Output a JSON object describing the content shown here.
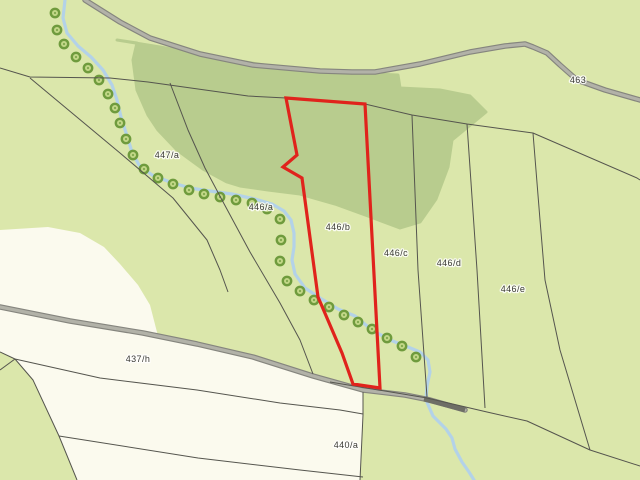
{
  "map": {
    "width": 640,
    "height": 480,
    "colors": {
      "field_green": "#dbe7ab",
      "forest_green": "#b8cc8e",
      "white_parcel": "#fbfaee",
      "stream_blue": "#b3d2e8",
      "tree_ring": "#6f9b3d",
      "tree_fill": "#c2d787",
      "road_casing": "#85857e",
      "road_fill": "#b2b2a8",
      "road_dark_segment": "#6e6e66",
      "boundary_line": "#55554e",
      "selected_parcel_red": "#e0231c",
      "label_text": "#3b3b35"
    },
    "selected_parcel": {
      "label": "446/b",
      "points": [
        [
          286,
          98
        ],
        [
          365,
          104
        ],
        [
          380,
          388
        ],
        [
          353,
          384
        ],
        [
          342,
          353
        ],
        [
          318,
          297
        ],
        [
          302,
          178
        ],
        [
          283,
          167
        ],
        [
          297,
          155
        ]
      ]
    },
    "labels": [
      {
        "id": "road-463",
        "text": "463",
        "x": 578,
        "y": 83
      },
      {
        "id": "parcel-447a",
        "text": "447/a",
        "x": 167,
        "y": 158
      },
      {
        "id": "parcel-446a",
        "text": "446/a",
        "x": 261,
        "y": 210
      },
      {
        "id": "parcel-446b",
        "text": "446/b",
        "x": 338,
        "y": 230
      },
      {
        "id": "parcel-446c",
        "text": "446/c",
        "x": 396,
        "y": 256
      },
      {
        "id": "parcel-446d",
        "text": "446/d",
        "x": 449,
        "y": 266
      },
      {
        "id": "parcel-446e",
        "text": "446/e",
        "x": 513,
        "y": 292
      },
      {
        "id": "parcel-437h",
        "text": "437/h",
        "x": 138,
        "y": 362
      },
      {
        "id": "parcel-440a",
        "text": "440/a",
        "x": 346,
        "y": 448
      }
    ],
    "geometry": {
      "forest": [
        [
          117,
          40
        ],
        [
          160,
          47
        ],
        [
          215,
          57
        ],
        [
          270,
          66
        ],
        [
          330,
          72
        ],
        [
          398,
          75
        ],
        [
          400,
          88
        ],
        [
          440,
          90
        ],
        [
          470,
          96
        ],
        [
          486,
          112
        ],
        [
          452,
          140
        ],
        [
          448,
          167
        ],
        [
          436,
          199
        ],
        [
          420,
          222
        ],
        [
          400,
          228
        ],
        [
          368,
          216
        ],
        [
          335,
          204
        ],
        [
          300,
          194
        ],
        [
          268,
          190
        ],
        [
          240,
          186
        ],
        [
          227,
          182
        ],
        [
          203,
          169
        ],
        [
          177,
          150
        ],
        [
          158,
          130
        ],
        [
          148,
          115
        ],
        [
          137,
          90
        ],
        [
          133,
          60
        ],
        [
          137,
          43
        ]
      ],
      "white_blob_above_road": [
        [
          0,
          230
        ],
        [
          48,
          227
        ],
        [
          80,
          233
        ],
        [
          104,
          247
        ],
        [
          120,
          264
        ],
        [
          138,
          285
        ],
        [
          150,
          305
        ],
        [
          158,
          336
        ],
        [
          100,
          325
        ],
        [
          40,
          314
        ],
        [
          0,
          307
        ]
      ],
      "white_area_below_road": [
        [
          0,
          309
        ],
        [
          70,
          322
        ],
        [
          143,
          334
        ],
        [
          197,
          345
        ],
        [
          253,
          358
        ],
        [
          313,
          378
        ],
        [
          363,
          392
        ],
        [
          363,
          415
        ],
        [
          360,
          480
        ],
        [
          77,
          480
        ],
        [
          59,
          436
        ],
        [
          33,
          380
        ],
        [
          15,
          359
        ],
        [
          0,
          352
        ]
      ],
      "stream": [
        [
          65,
          0
        ],
        [
          63,
          18
        ],
        [
          67,
          33
        ],
        [
          78,
          46
        ],
        [
          91,
          57
        ],
        [
          103,
          70
        ],
        [
          112,
          85
        ],
        [
          117,
          100
        ],
        [
          121,
          117
        ],
        [
          127,
          136
        ],
        [
          132,
          152
        ],
        [
          139,
          165
        ],
        [
          152,
          175
        ],
        [
          170,
          182
        ],
        [
          190,
          188
        ],
        [
          210,
          191
        ],
        [
          232,
          194
        ],
        [
          255,
          199
        ],
        [
          272,
          204
        ],
        [
          284,
          211
        ],
        [
          291,
          220
        ],
        [
          294,
          233
        ],
        [
          294,
          247
        ],
        [
          292,
          260
        ],
        [
          295,
          274
        ],
        [
          305,
          288
        ],
        [
          320,
          298
        ],
        [
          338,
          309
        ],
        [
          355,
          316
        ],
        [
          372,
          330
        ],
        [
          390,
          340
        ],
        [
          408,
          347
        ],
        [
          420,
          352
        ],
        [
          428,
          360
        ],
        [
          430,
          372
        ],
        [
          427,
          386
        ],
        [
          426,
          400
        ],
        [
          433,
          416
        ],
        [
          446,
          429
        ],
        [
          452,
          438
        ],
        [
          455,
          449
        ],
        [
          462,
          462
        ],
        [
          469,
          472
        ],
        [
          474,
          480
        ]
      ],
      "trees": [
        [
          55,
          13
        ],
        [
          57,
          30
        ],
        [
          64,
          44
        ],
        [
          76,
          57
        ],
        [
          88,
          68
        ],
        [
          99,
          80
        ],
        [
          108,
          94
        ],
        [
          115,
          108
        ],
        [
          120,
          123
        ],
        [
          126,
          139
        ],
        [
          133,
          155
        ],
        [
          144,
          169
        ],
        [
          158,
          178
        ],
        [
          173,
          184
        ],
        [
          189,
          190
        ],
        [
          204,
          194
        ],
        [
          220,
          197
        ],
        [
          236,
          200
        ],
        [
          252,
          203
        ],
        [
          267,
          209
        ],
        [
          280,
          219
        ],
        [
          281,
          240
        ],
        [
          280,
          261
        ],
        [
          287,
          281
        ],
        [
          300,
          291
        ],
        [
          314,
          300
        ],
        [
          329,
          307
        ],
        [
          344,
          315
        ],
        [
          358,
          322
        ],
        [
          372,
          329
        ],
        [
          387,
          338
        ],
        [
          402,
          346
        ],
        [
          416,
          357
        ]
      ],
      "road_upper": [
        [
          85,
          0
        ],
        [
          120,
          22
        ],
        [
          150,
          38
        ],
        [
          200,
          54
        ],
        [
          253,
          65
        ],
        [
          320,
          71
        ],
        [
          352,
          72
        ],
        [
          375,
          72
        ],
        [
          420,
          64
        ],
        [
          470,
          52
        ],
        [
          505,
          46
        ],
        [
          525,
          44
        ],
        [
          533,
          47
        ],
        [
          547,
          53
        ],
        [
          560,
          65
        ],
        [
          577,
          80
        ],
        [
          605,
          90
        ],
        [
          640,
          100
        ]
      ],
      "road_lower": [
        [
          0,
          307
        ],
        [
          70,
          321
        ],
        [
          143,
          333
        ],
        [
          197,
          344
        ],
        [
          253,
          357
        ],
        [
          313,
          376
        ],
        [
          363,
          390
        ],
        [
          405,
          395
        ],
        [
          430,
          400
        ],
        [
          465,
          410
        ]
      ],
      "road_lower_dark_segment": [
        [
          424,
          399
        ],
        [
          465,
          410
        ]
      ],
      "boundaries": [
        {
          "name": "boundary-top",
          "points": [
            [
              0,
              68
            ],
            [
              30,
              77
            ],
            [
              110,
              78
            ],
            [
              148,
              82
            ],
            [
              248,
              96
            ],
            [
              286,
              98
            ],
            [
              365,
              104
            ],
            [
              412,
              115
            ],
            [
              467,
              124
            ],
            [
              533,
              133
            ],
            [
              637,
              178
            ],
            [
              640,
              180
            ]
          ]
        },
        {
          "name": "boundary-left-diag",
          "points": [
            [
              30,
              78
            ],
            [
              120,
              153
            ],
            [
              173,
              198
            ],
            [
              207,
              240
            ],
            [
              220,
              270
            ],
            [
              228,
              292
            ]
          ]
        },
        {
          "name": "boundary-447a-446a",
          "points": [
            [
              170,
              83
            ],
            [
              188,
              130
            ],
            [
              205,
              168
            ],
            [
              222,
              200
            ],
            [
              250,
              252
            ],
            [
              280,
              303
            ],
            [
              300,
              340
            ],
            [
              313,
              374
            ]
          ]
        },
        {
          "name": "boundary-446c-446d",
          "points": [
            [
              412,
              115
            ],
            [
              418,
              270
            ],
            [
              427,
              397
            ]
          ]
        },
        {
          "name": "boundary-446d-446e",
          "points": [
            [
              467,
              124
            ],
            [
              477,
              270
            ],
            [
              485,
              408
            ]
          ]
        },
        {
          "name": "boundary-446e-east",
          "points": [
            [
              533,
              133
            ],
            [
              540,
              220
            ],
            [
              545,
              280
            ],
            [
              560,
              350
            ],
            [
              590,
              450
            ]
          ]
        },
        {
          "name": "boundary-south-long",
          "points": [
            [
              330,
              382
            ],
            [
              427,
              398
            ],
            [
              487,
              412
            ],
            [
              527,
              421
            ],
            [
              590,
              450
            ],
            [
              640,
              466
            ]
          ]
        },
        {
          "name": "boundary-junction-up",
          "points": [
            [
              0,
              352
            ],
            [
              15,
              359
            ]
          ]
        },
        {
          "name": "boundary-junction-dn",
          "points": [
            [
              15,
              359
            ],
            [
              0,
              370
            ]
          ]
        },
        {
          "name": "boundary-white-west",
          "points": [
            [
              15,
              359
            ],
            [
              33,
              380
            ],
            [
              59,
              436
            ],
            [
              77,
              480
            ]
          ]
        },
        {
          "name": "boundary-437h-south",
          "points": [
            [
              15,
              359
            ],
            [
              100,
              378
            ],
            [
              197,
              390
            ],
            [
              280,
              403
            ],
            [
              340,
              410
            ],
            [
              363,
              414
            ]
          ]
        },
        {
          "name": "boundary-440a-south",
          "points": [
            [
              59,
              436
            ],
            [
              198,
              458
            ],
            [
              300,
              470
            ],
            [
              363,
              477
            ]
          ]
        },
        {
          "name": "boundary-white-east",
          "points": [
            [
              363,
              392
            ],
            [
              363,
              415
            ],
            [
              360,
              480
            ]
          ]
        }
      ]
    }
  }
}
